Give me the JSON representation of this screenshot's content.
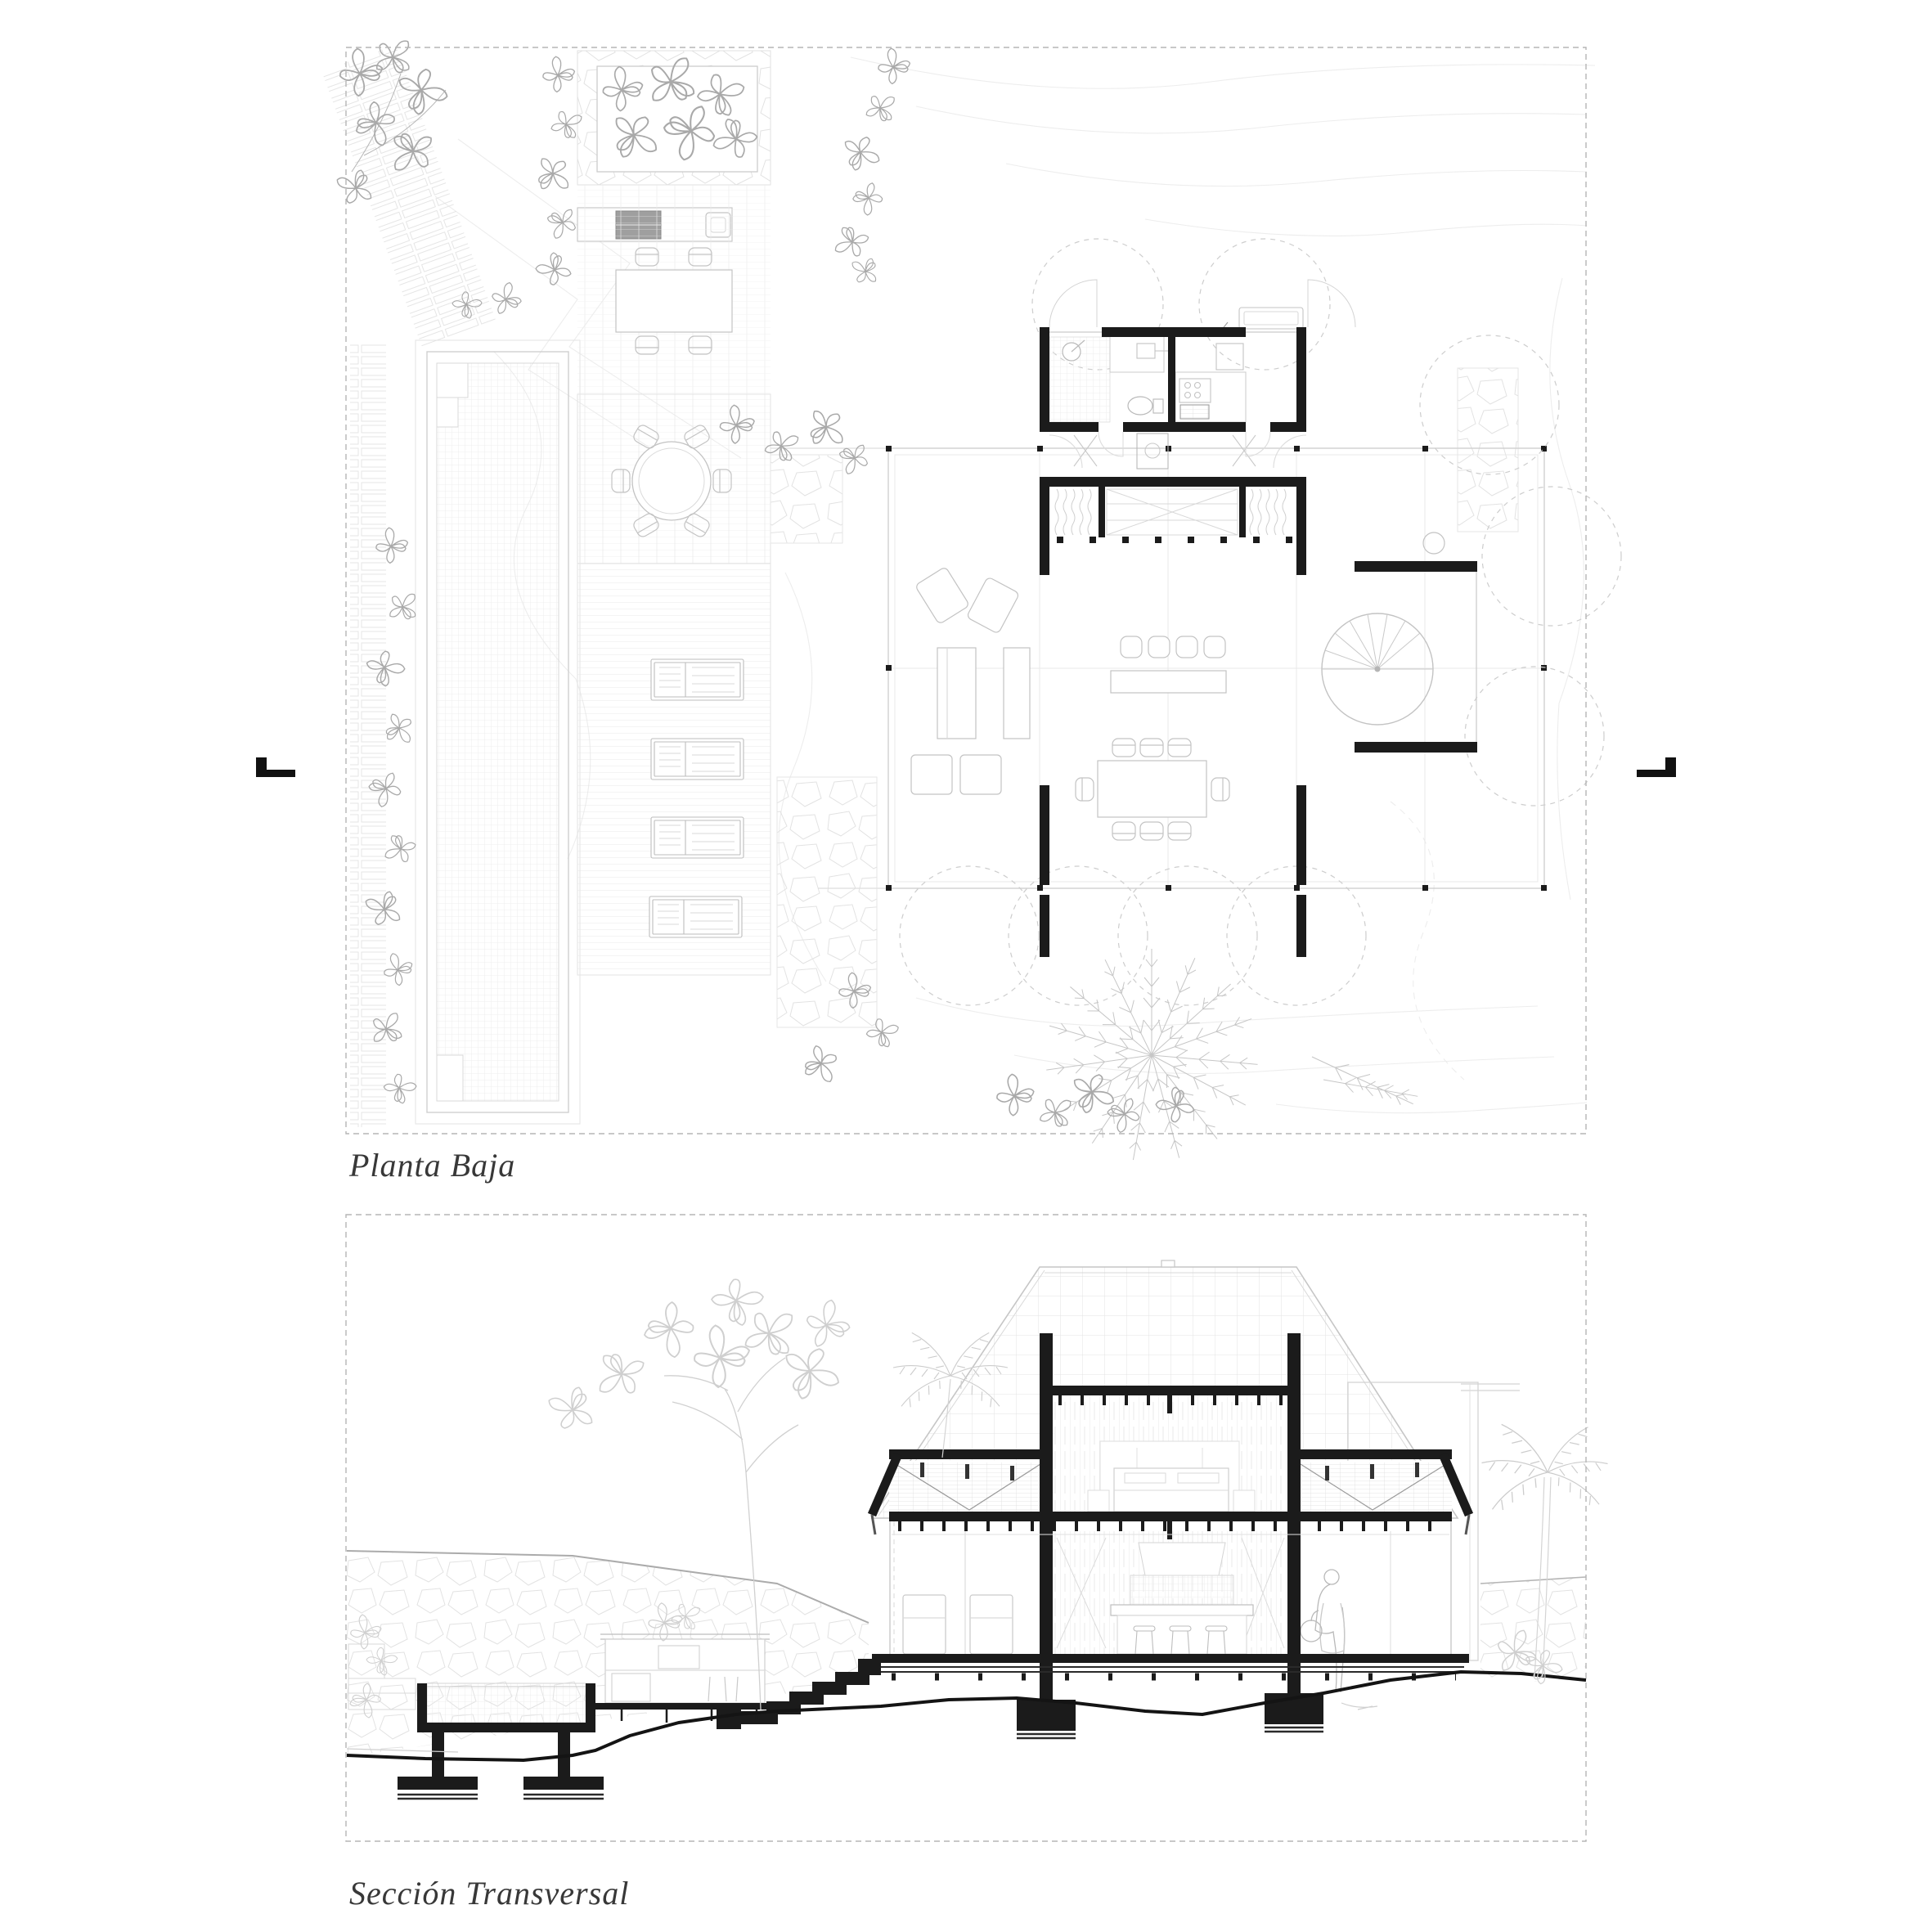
{
  "sheet": {
    "plan_label": "Planta Baja",
    "section_label": "Sección Transversal"
  },
  "icons": {
    "section_cut_marker_left": "black L-shaped section cut symbol",
    "section_cut_marker_right": "black L-shaped section cut symbol (mirrored)"
  },
  "colors": {
    "paper": "#ffffff",
    "poche_black": "#1b1b1b",
    "line_faint": "#ececec",
    "line_light": "#d6d6d6",
    "line_mid": "#c3c3c3",
    "line_dark": "#9e9e9e",
    "label_ink": "#383838",
    "frame_dash": "#b5b5b5"
  }
}
